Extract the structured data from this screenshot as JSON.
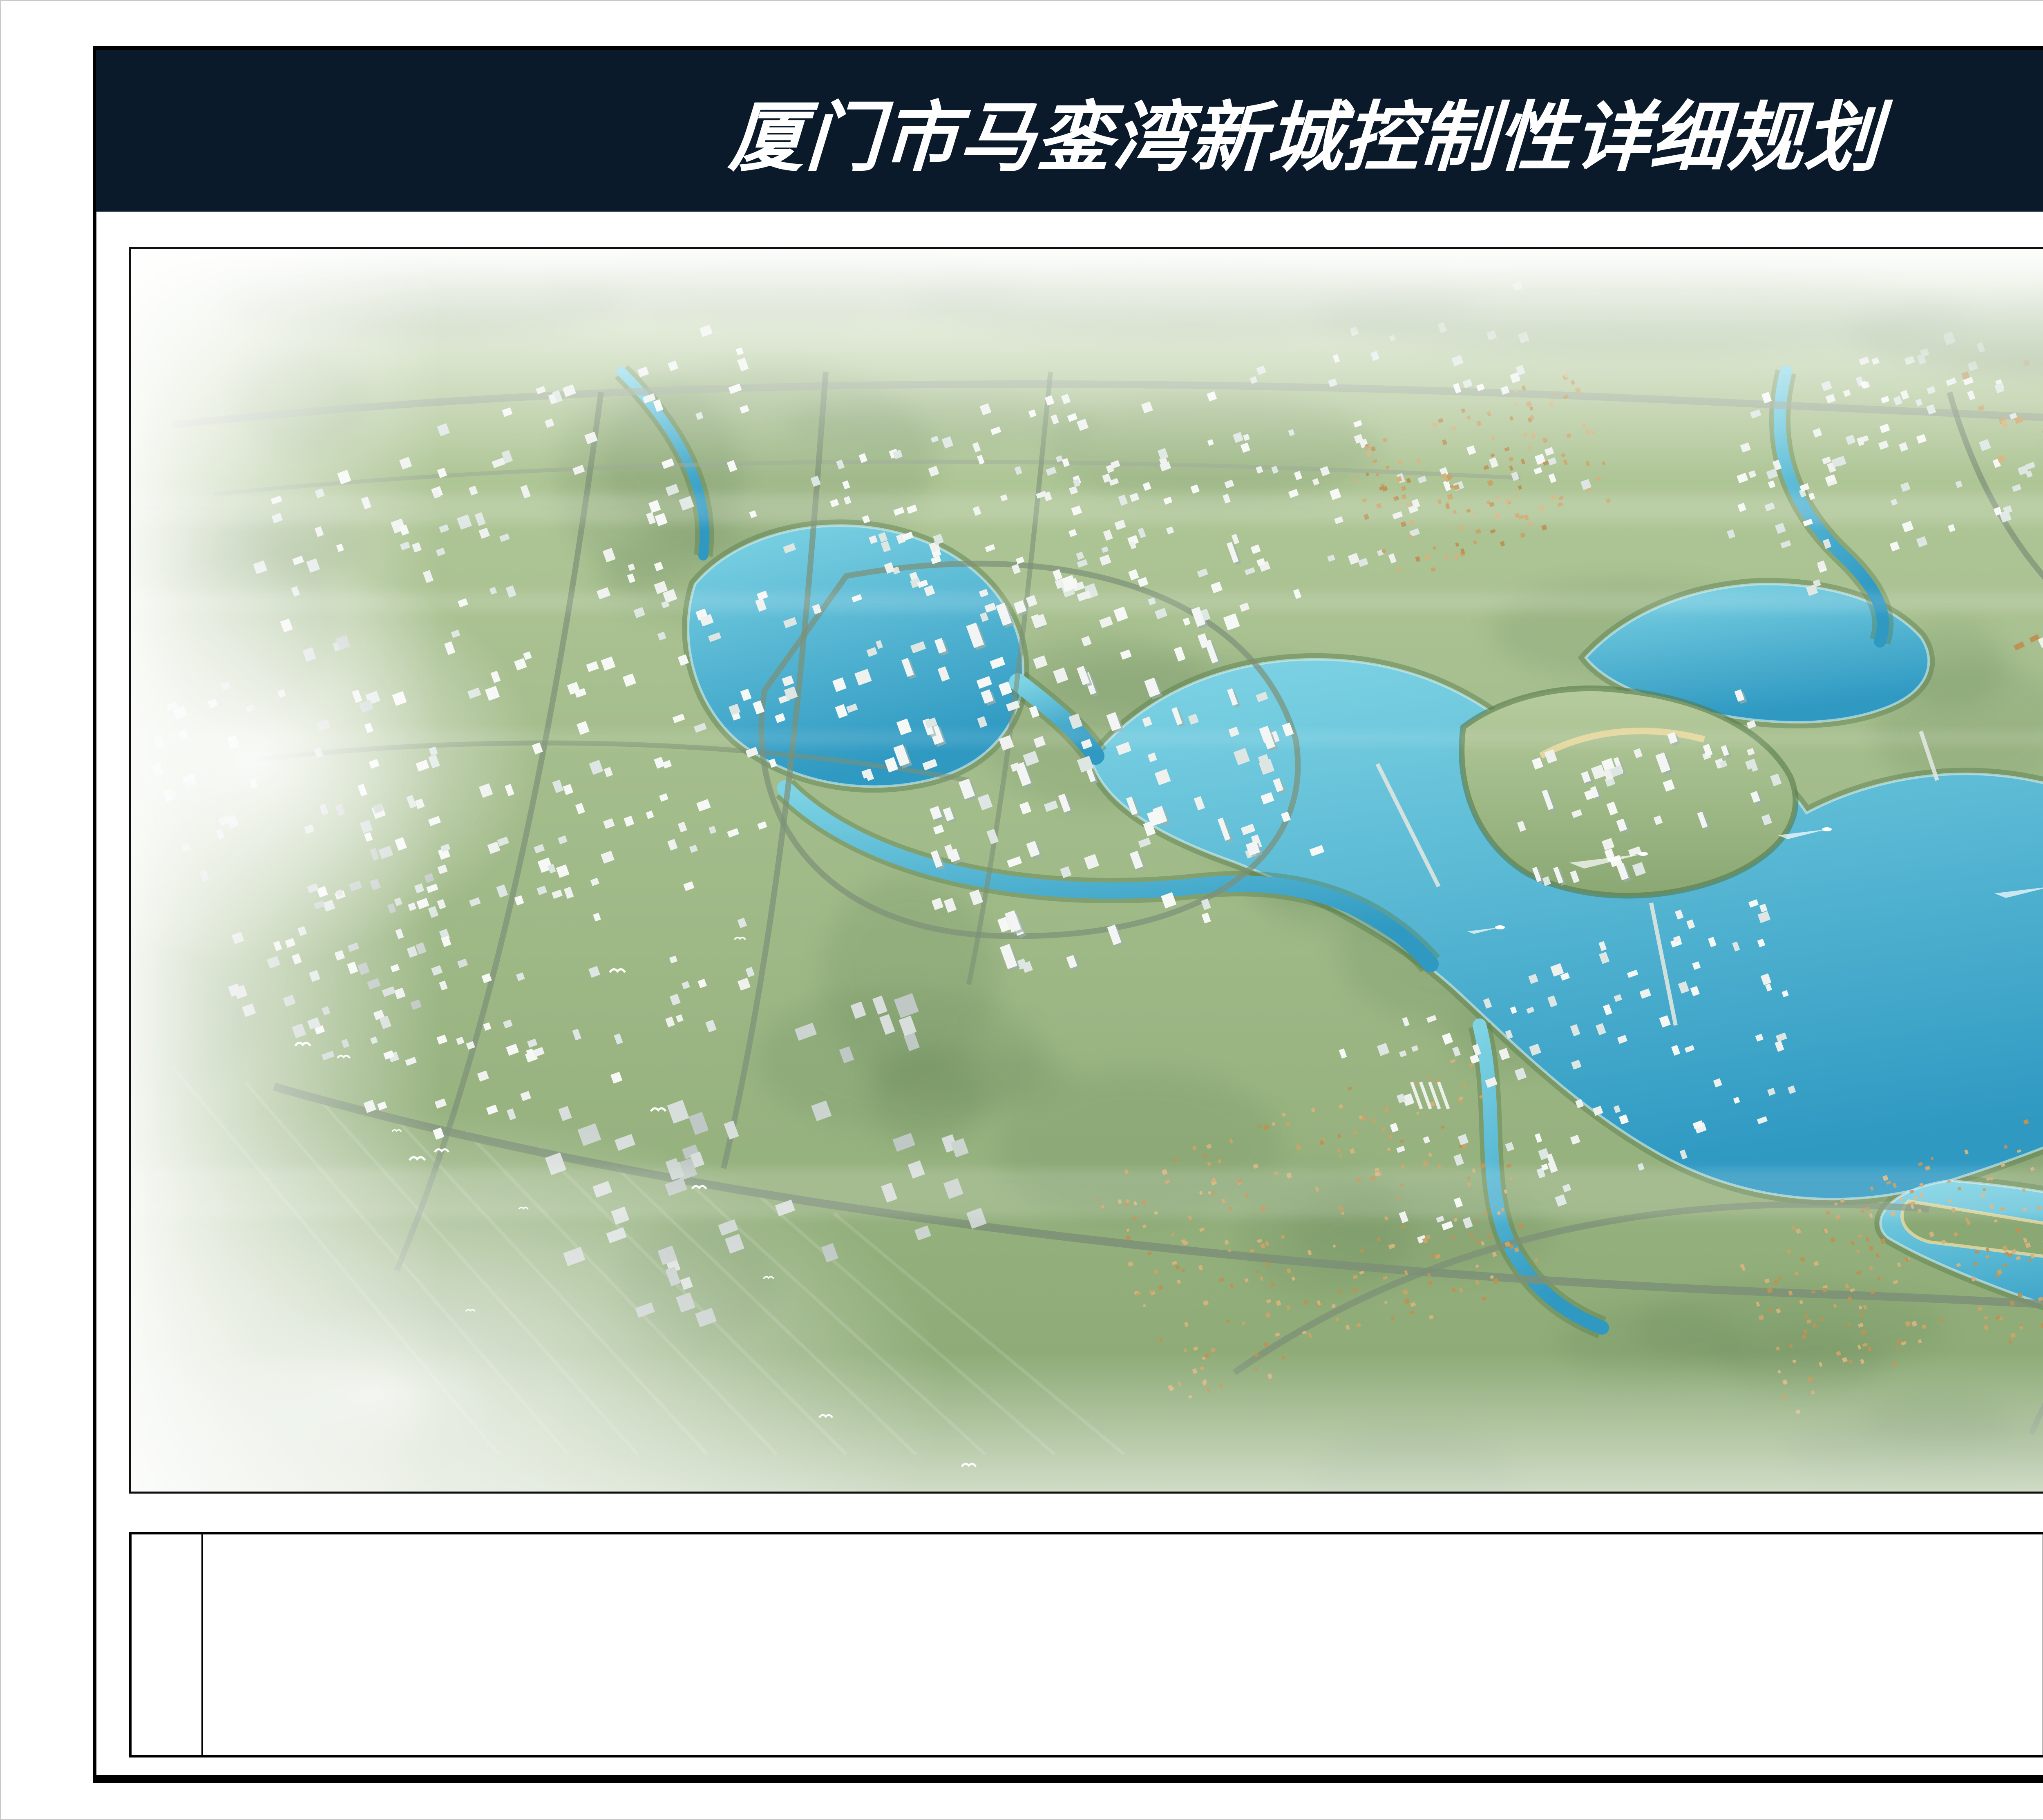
{
  "header": {
    "title": "厦门市马銮湾新城控制性详细规划",
    "bg_color": "#0a1a2b",
    "text_color": "#ffffff"
  },
  "artwork": {
    "calligraphy_columns": [
      "撷朐挽文晴",
      "鸣梦高色入",
      "雲海雯之露",
      "在蒦日月菊",
      "诗才何乞音",
      "或诌仁稀礼",
      "庭当守宝之",
      "撰有图"
    ],
    "seal_color": "#a83228"
  },
  "title_block": {
    "drawing_label": "规划总体鸟瞰图",
    "institute_cn": "中国城市规划设计研究院厦门分院",
    "institute_en": "CHINA ACADEMY OF URBAN PLANNING & DESIGN XIAMEN BRANCH",
    "committee": "厦门市规划委员会"
  },
  "scene": {
    "palette": {
      "land_light": "#b7cc9e",
      "land_dark": "#8aa873",
      "veg_shade": "#5f7f52",
      "water_light": "#7fd4e4",
      "water_deep": "#2f99c2",
      "shore_trees": "#567a49",
      "shore_foam": "#d6f1f4",
      "road": "#7c9077",
      "road_light": "#9aa895",
      "building_white": "#eef1ee",
      "building_gray": "#ccd4d0",
      "village_tan": "#c9a468",
      "tower_shadow": "#9cb0aa",
      "sand": "#ead9a0",
      "haze": "#ffffff",
      "hill": "#6b8a5d"
    }
  }
}
